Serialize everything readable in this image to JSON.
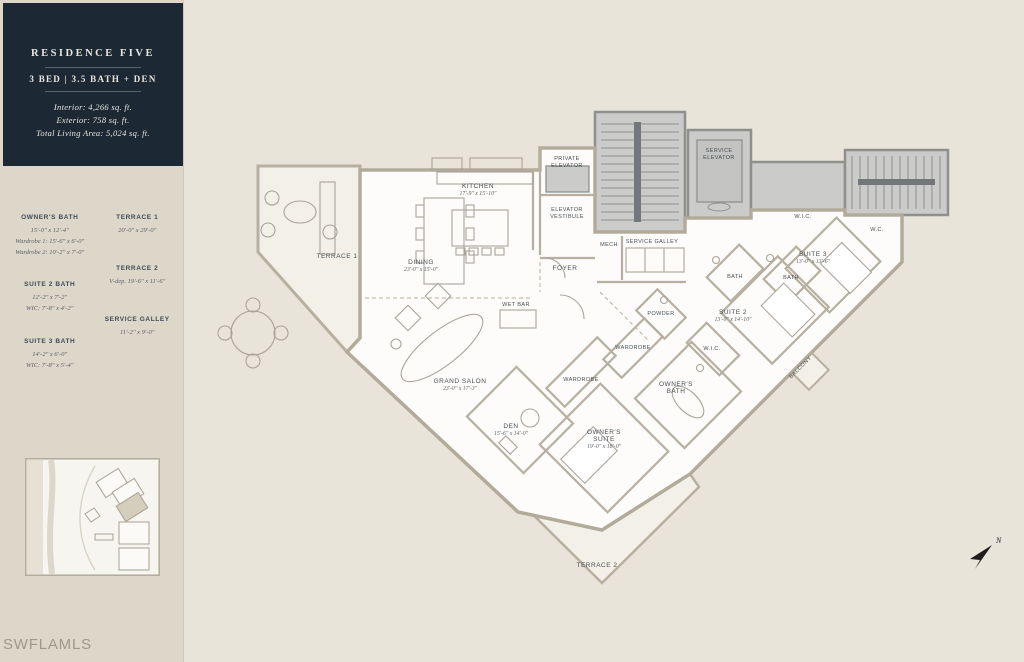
{
  "branding": {
    "watermark": "SWFLAMLS"
  },
  "sidebar": {
    "header": {
      "title": "RESIDENCE FIVE",
      "subtitle": "3 BED | 3.5 BATH + DEN",
      "interior": "Interior: 4,266 sq. ft.",
      "exterior": "Exterior: 758 sq. ft.",
      "total": "Total Living Area: 5,024 sq. ft."
    },
    "columns": {
      "left": [
        {
          "name": "OWNER'S BATH",
          "lines": [
            "15'-0\" x 12'-4\"",
            "Wardrobe 1: 15'-6\" x 6'-0\"",
            "Wardrobe 2: 10'-2\" x 7'-0\""
          ]
        },
        {
          "name": "SUITE 2 BATH",
          "lines": [
            "12'-2\" x 7'-2\"",
            "WIC: 7'-8\" x 4'-2\""
          ]
        },
        {
          "name": "SUITE 3 BATH",
          "lines": [
            "14'-2\" x 6'-0\"",
            "WIC: 7'-8\" x 5'-4\""
          ]
        }
      ],
      "right": [
        {
          "name": "TERRACE 1",
          "lines": [
            "20'-0\" x 29'-0\""
          ]
        },
        {
          "name": "TERRACE 2",
          "lines": [
            "V-dep. 19'-6\" x 11'-6\""
          ]
        },
        {
          "name": "SERVICE GALLEY",
          "lines": [
            "11'-2\" x 9'-0\""
          ]
        }
      ]
    }
  },
  "plan": {
    "rooms": {
      "private_elevator": {
        "l1": "PRIVATE",
        "l2": "ELEVATOR"
      },
      "service_elevator": {
        "l1": "SERVICE",
        "l2": "ELEVATOR"
      },
      "elevator_vestibule": {
        "l1": "ELEVATOR",
        "l2": "VESTIBULE"
      },
      "kitchen": {
        "l1": "KITCHEN",
        "dim": "17'-9\" x 15'-10\""
      },
      "mech": {
        "l1": "MECH"
      },
      "service_galley": {
        "l1": "SERVICE GALLEY"
      },
      "foyer": {
        "l1": "FOYER"
      },
      "terrace1": {
        "l1": "TERRACE 1"
      },
      "dining": {
        "l1": "DINING",
        "dim": "23'-0\" x 15'-0\""
      },
      "wet_bar": {
        "l1": "WET BAR"
      },
      "grand_salon": {
        "l1": "GRAND SALON",
        "dim": "23'-0\" x 17'-3\""
      },
      "den": {
        "l1": "DEN",
        "dim": "15'-6\" x 14'-0\""
      },
      "wardrobe_den": {
        "l1": "WARDROBE"
      },
      "wardrobe_owner": {
        "l1": "WARDROBE"
      },
      "powder": {
        "l1": "POWDER"
      },
      "wic_owner": {
        "l1": "W.I.C."
      },
      "wic_suite3": {
        "l1": "W.I.C."
      },
      "wc": {
        "l1": "W.C."
      },
      "suite3": {
        "l1": "SUITE 3",
        "dim": "13'-0\" x 13'-6\""
      },
      "bath_suite2": {
        "l1": "BATH"
      },
      "bath_suite3": {
        "l1": "BATH"
      },
      "suite2": {
        "l1": "SUITE 2",
        "dim": "13'-0\" x 14'-10\""
      },
      "owners_bath": {
        "l1": "OWNER'S",
        "l2": "BATH"
      },
      "balcony": {
        "l1": "BALCONY"
      },
      "owners_suite": {
        "l1": "OWNER'S",
        "l2": "SUITE",
        "dim": "19'-0\" x 18'-0\""
      },
      "terrace2": {
        "l1": "TERRACE 2"
      }
    },
    "compass": {
      "label": "N"
    }
  }
}
